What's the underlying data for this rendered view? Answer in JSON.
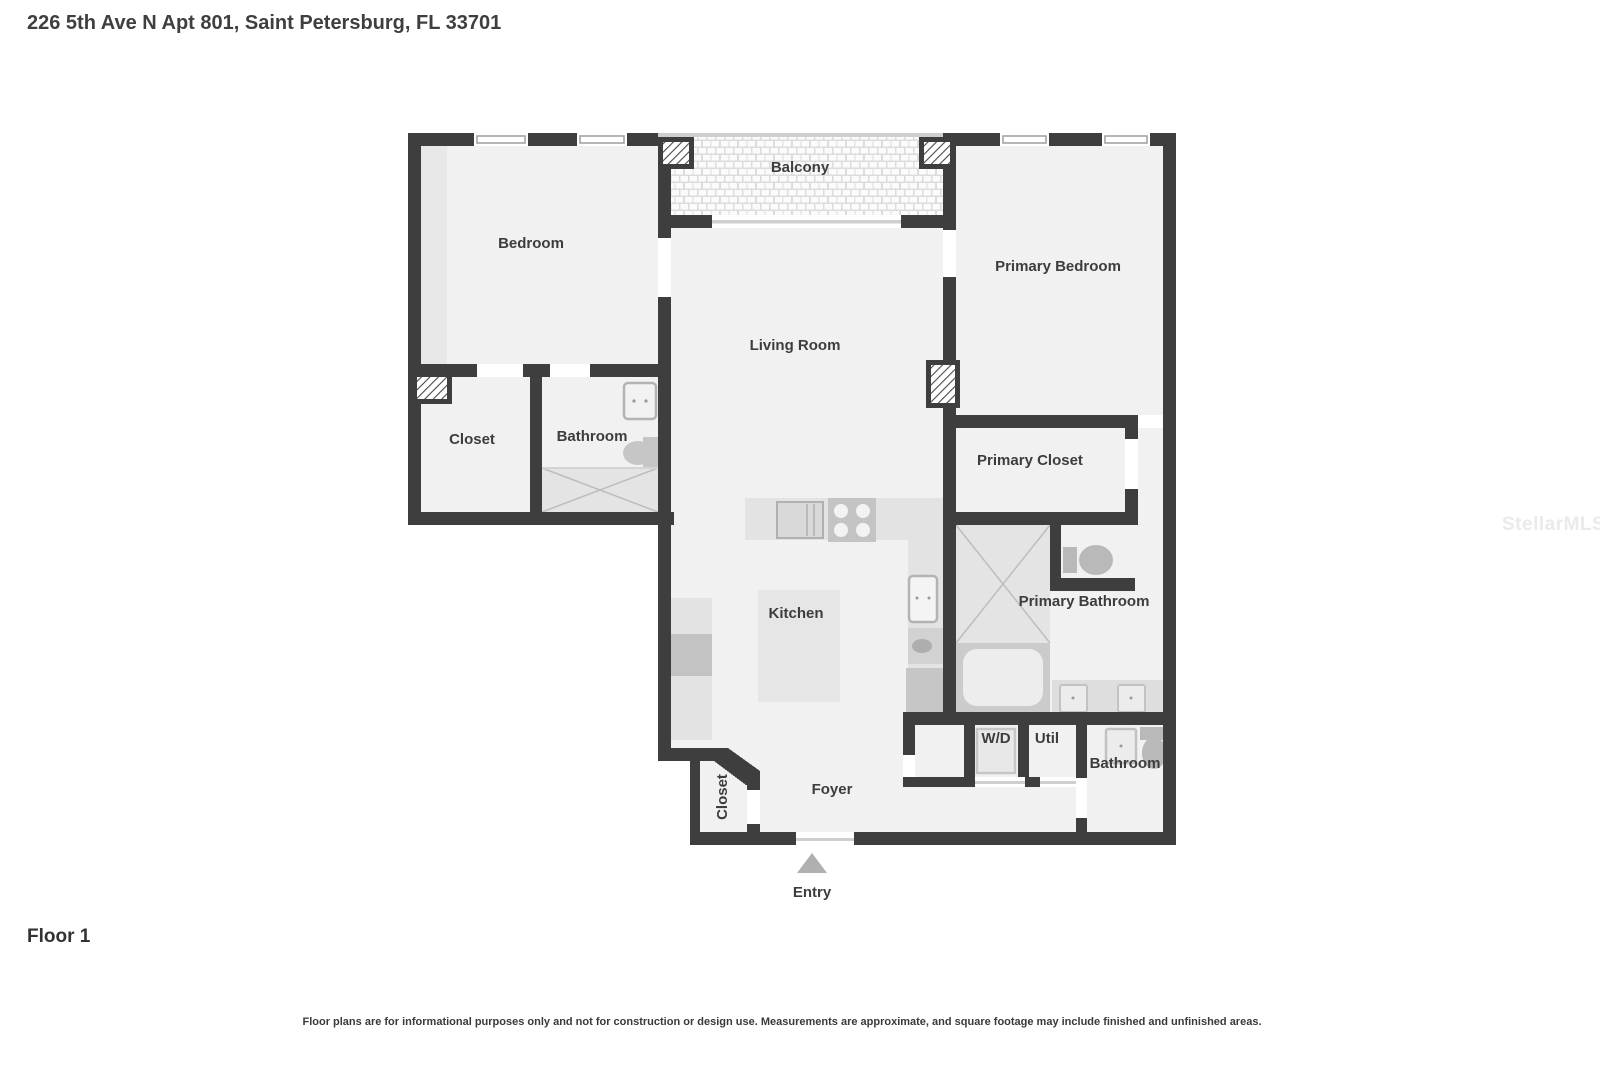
{
  "header": {
    "title": "226 5th Ave N Apt 801, Saint Petersburg, FL 33701"
  },
  "plan": {
    "rooms": {
      "bedroom": "Bedroom",
      "balcony": "Balcony",
      "primary_bedroom": "Primary Bedroom",
      "living_room": "Living Room",
      "closet": "Closet",
      "bathroom": "Bathroom",
      "primary_closet": "Primary Closet",
      "primary_bathroom": "Primary Bathroom",
      "kitchen": "Kitchen",
      "washer_dryer": "W/D",
      "utility": "Util",
      "bathroom_2": "Bathroom",
      "foyer_closet": "Closet",
      "foyer": "Foyer",
      "entry": "Entry"
    },
    "colors": {
      "wall": "#3e3e3e",
      "floor": "#f1f1f1",
      "fixture_light": "#e3e3e3",
      "fixture_medium": "#c6c6c6",
      "label_text": "#3d3d3d"
    }
  },
  "footer": {
    "floor_label": "Floor 1",
    "disclaimer": "Floor plans are for informational purposes only and not for construction or design use. Measurements are approximate, and square footage may include finished and unfinished areas."
  },
  "watermark": "StellarMLS"
}
